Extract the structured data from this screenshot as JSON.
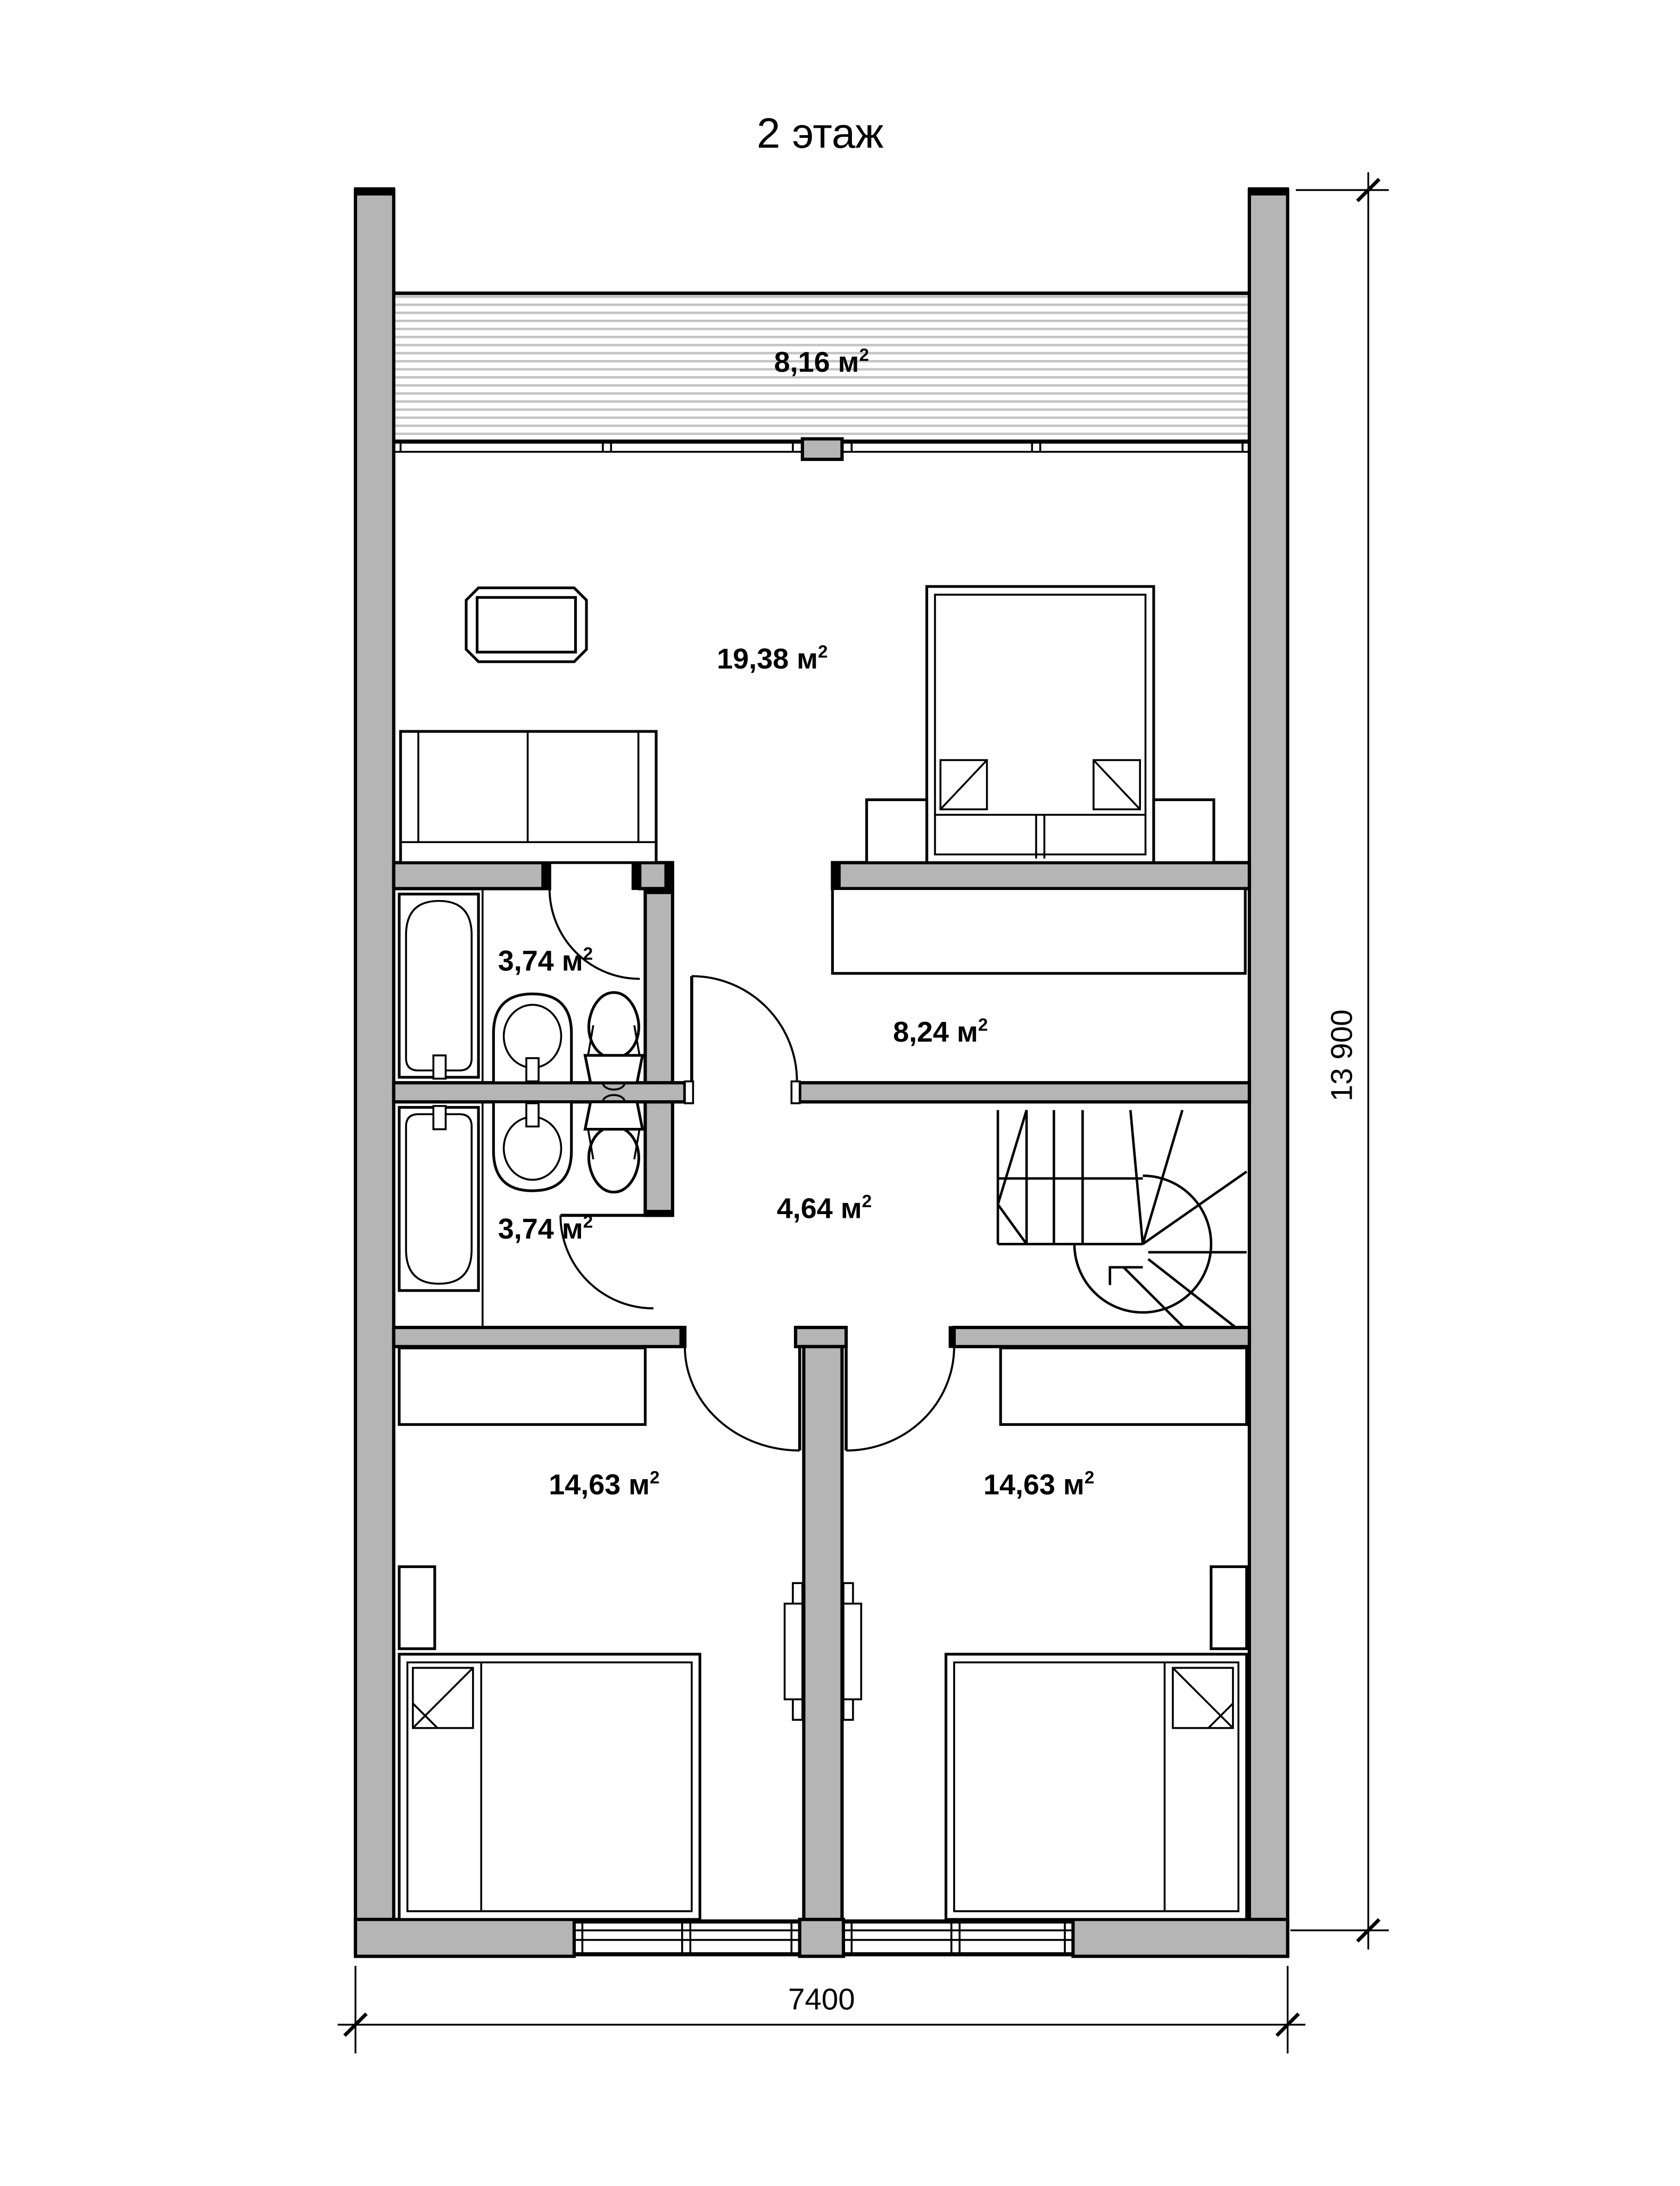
{
  "title": "2 этаж",
  "rooms": [
    {
      "id": "terrace",
      "label_main": "8,16 м",
      "label_sup": "2"
    },
    {
      "id": "living-room",
      "label_main": "19,38 м",
      "label_sup": "2"
    },
    {
      "id": "bathroom-top",
      "label_main": "3,74 м",
      "label_sup": "2"
    },
    {
      "id": "hall",
      "label_main": "8,24 м",
      "label_sup": "2"
    },
    {
      "id": "bathroom-bottom",
      "label_main": "3,74 м",
      "label_sup": "2"
    },
    {
      "id": "corridor",
      "label_main": "4,64 м",
      "label_sup": "2"
    },
    {
      "id": "bedroom-left",
      "label_main": "14,63 м",
      "label_sup": "2"
    },
    {
      "id": "bedroom-right",
      "label_main": "14,63 м",
      "label_sup": "2"
    }
  ],
  "dimensions": {
    "height_label": "13 900",
    "width_label": "7400"
  },
  "colors": {
    "wall_fill": "#b5b5b5",
    "hatch_line": "#c2c2c2",
    "line": "#000000",
    "background": "#ffffff"
  }
}
